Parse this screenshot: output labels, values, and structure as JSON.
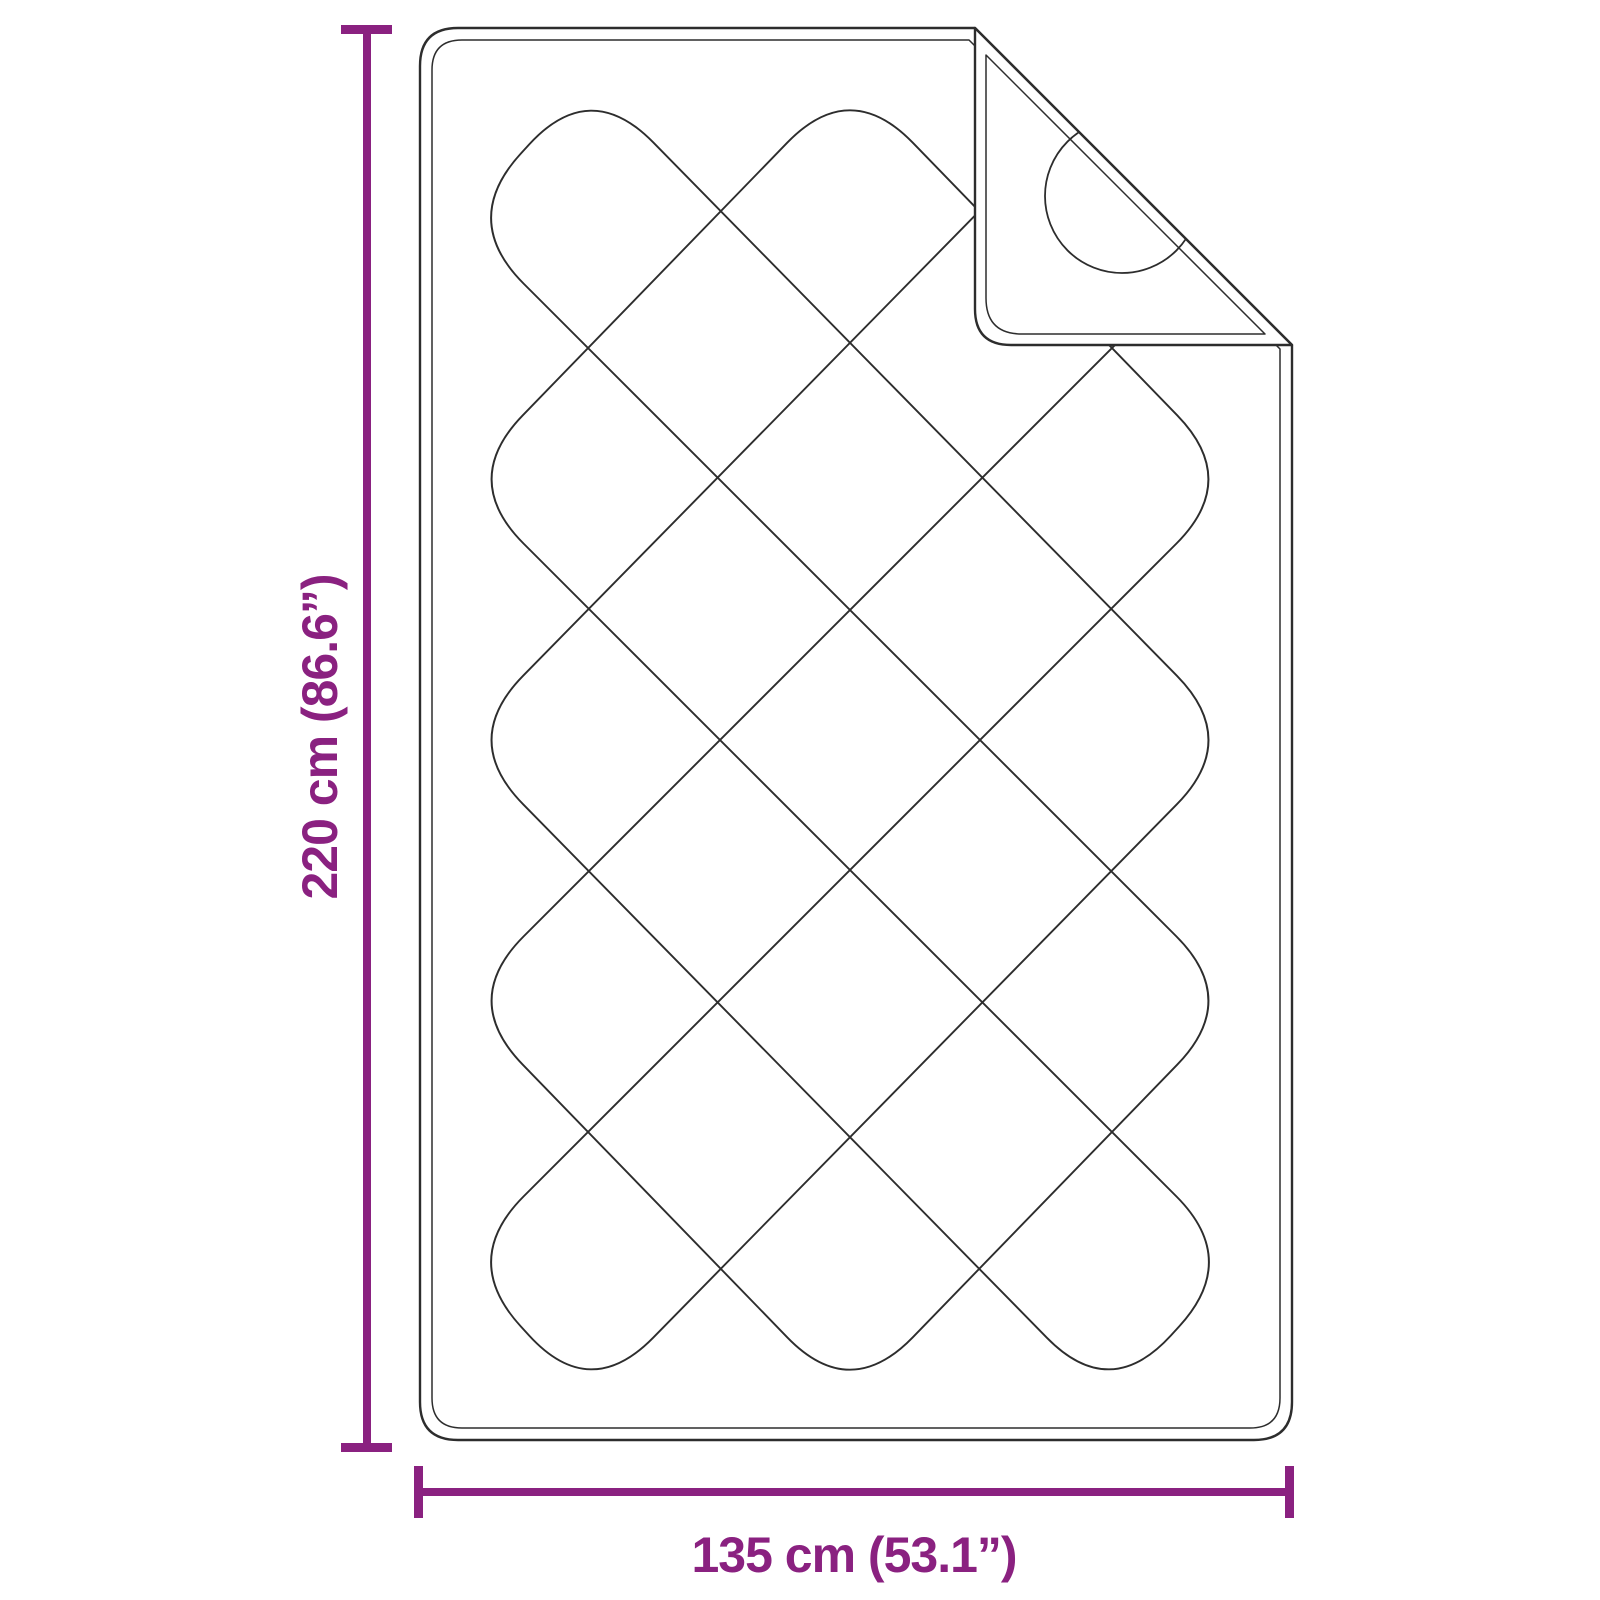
{
  "diagram": {
    "type": "product-dimension-diagram",
    "subject": "quilted blanket with folded corner",
    "background_color": "#ffffff",
    "line_color": "#2d2d2d",
    "accent_color": "#8A2180",
    "height_dimension": {
      "label": "220 cm (86.6”)",
      "value_cm": 220,
      "value_inches": 86.6,
      "orientation": "vertical"
    },
    "width_dimension": {
      "label": "135 cm (53.1”)",
      "value_cm": 135,
      "value_inches": 53.1,
      "orientation": "horizontal"
    }
  }
}
